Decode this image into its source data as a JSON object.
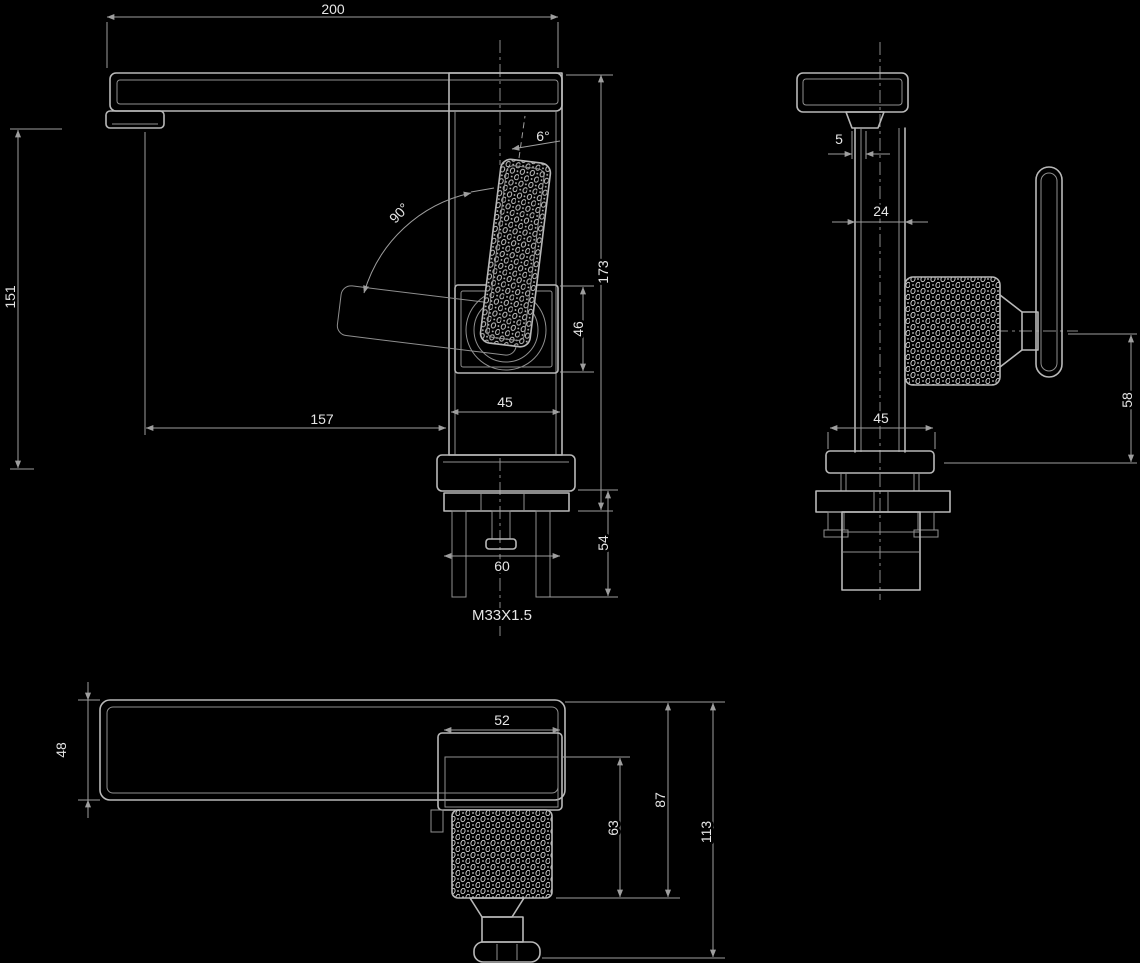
{
  "drawing_type": "faucet technical dimension drawing",
  "colors": {
    "background": "#000000",
    "outline": "#b8b8b8",
    "dimension_line": "#9e9e9e",
    "text": "#e6e6e6"
  },
  "front_view": {
    "overall_width": "200",
    "spout_height": "151",
    "spout_reach": "157",
    "handle_tilt": "6°",
    "handle_swing": "90°",
    "overall_height": "173",
    "body_height": "46",
    "body_width": "45",
    "under_counter_depth": "54",
    "base_width": "60",
    "thread": "M33X1.5"
  },
  "side_view": {
    "aerator_lip": "5",
    "body_depth": "24",
    "base_width": "45",
    "handle_height": "58"
  },
  "bottom_view": {
    "spout_width": "48",
    "body_width": "52",
    "handle_knurl_length": "63",
    "body_handle_depth": "87",
    "overall_depth": "113"
  }
}
